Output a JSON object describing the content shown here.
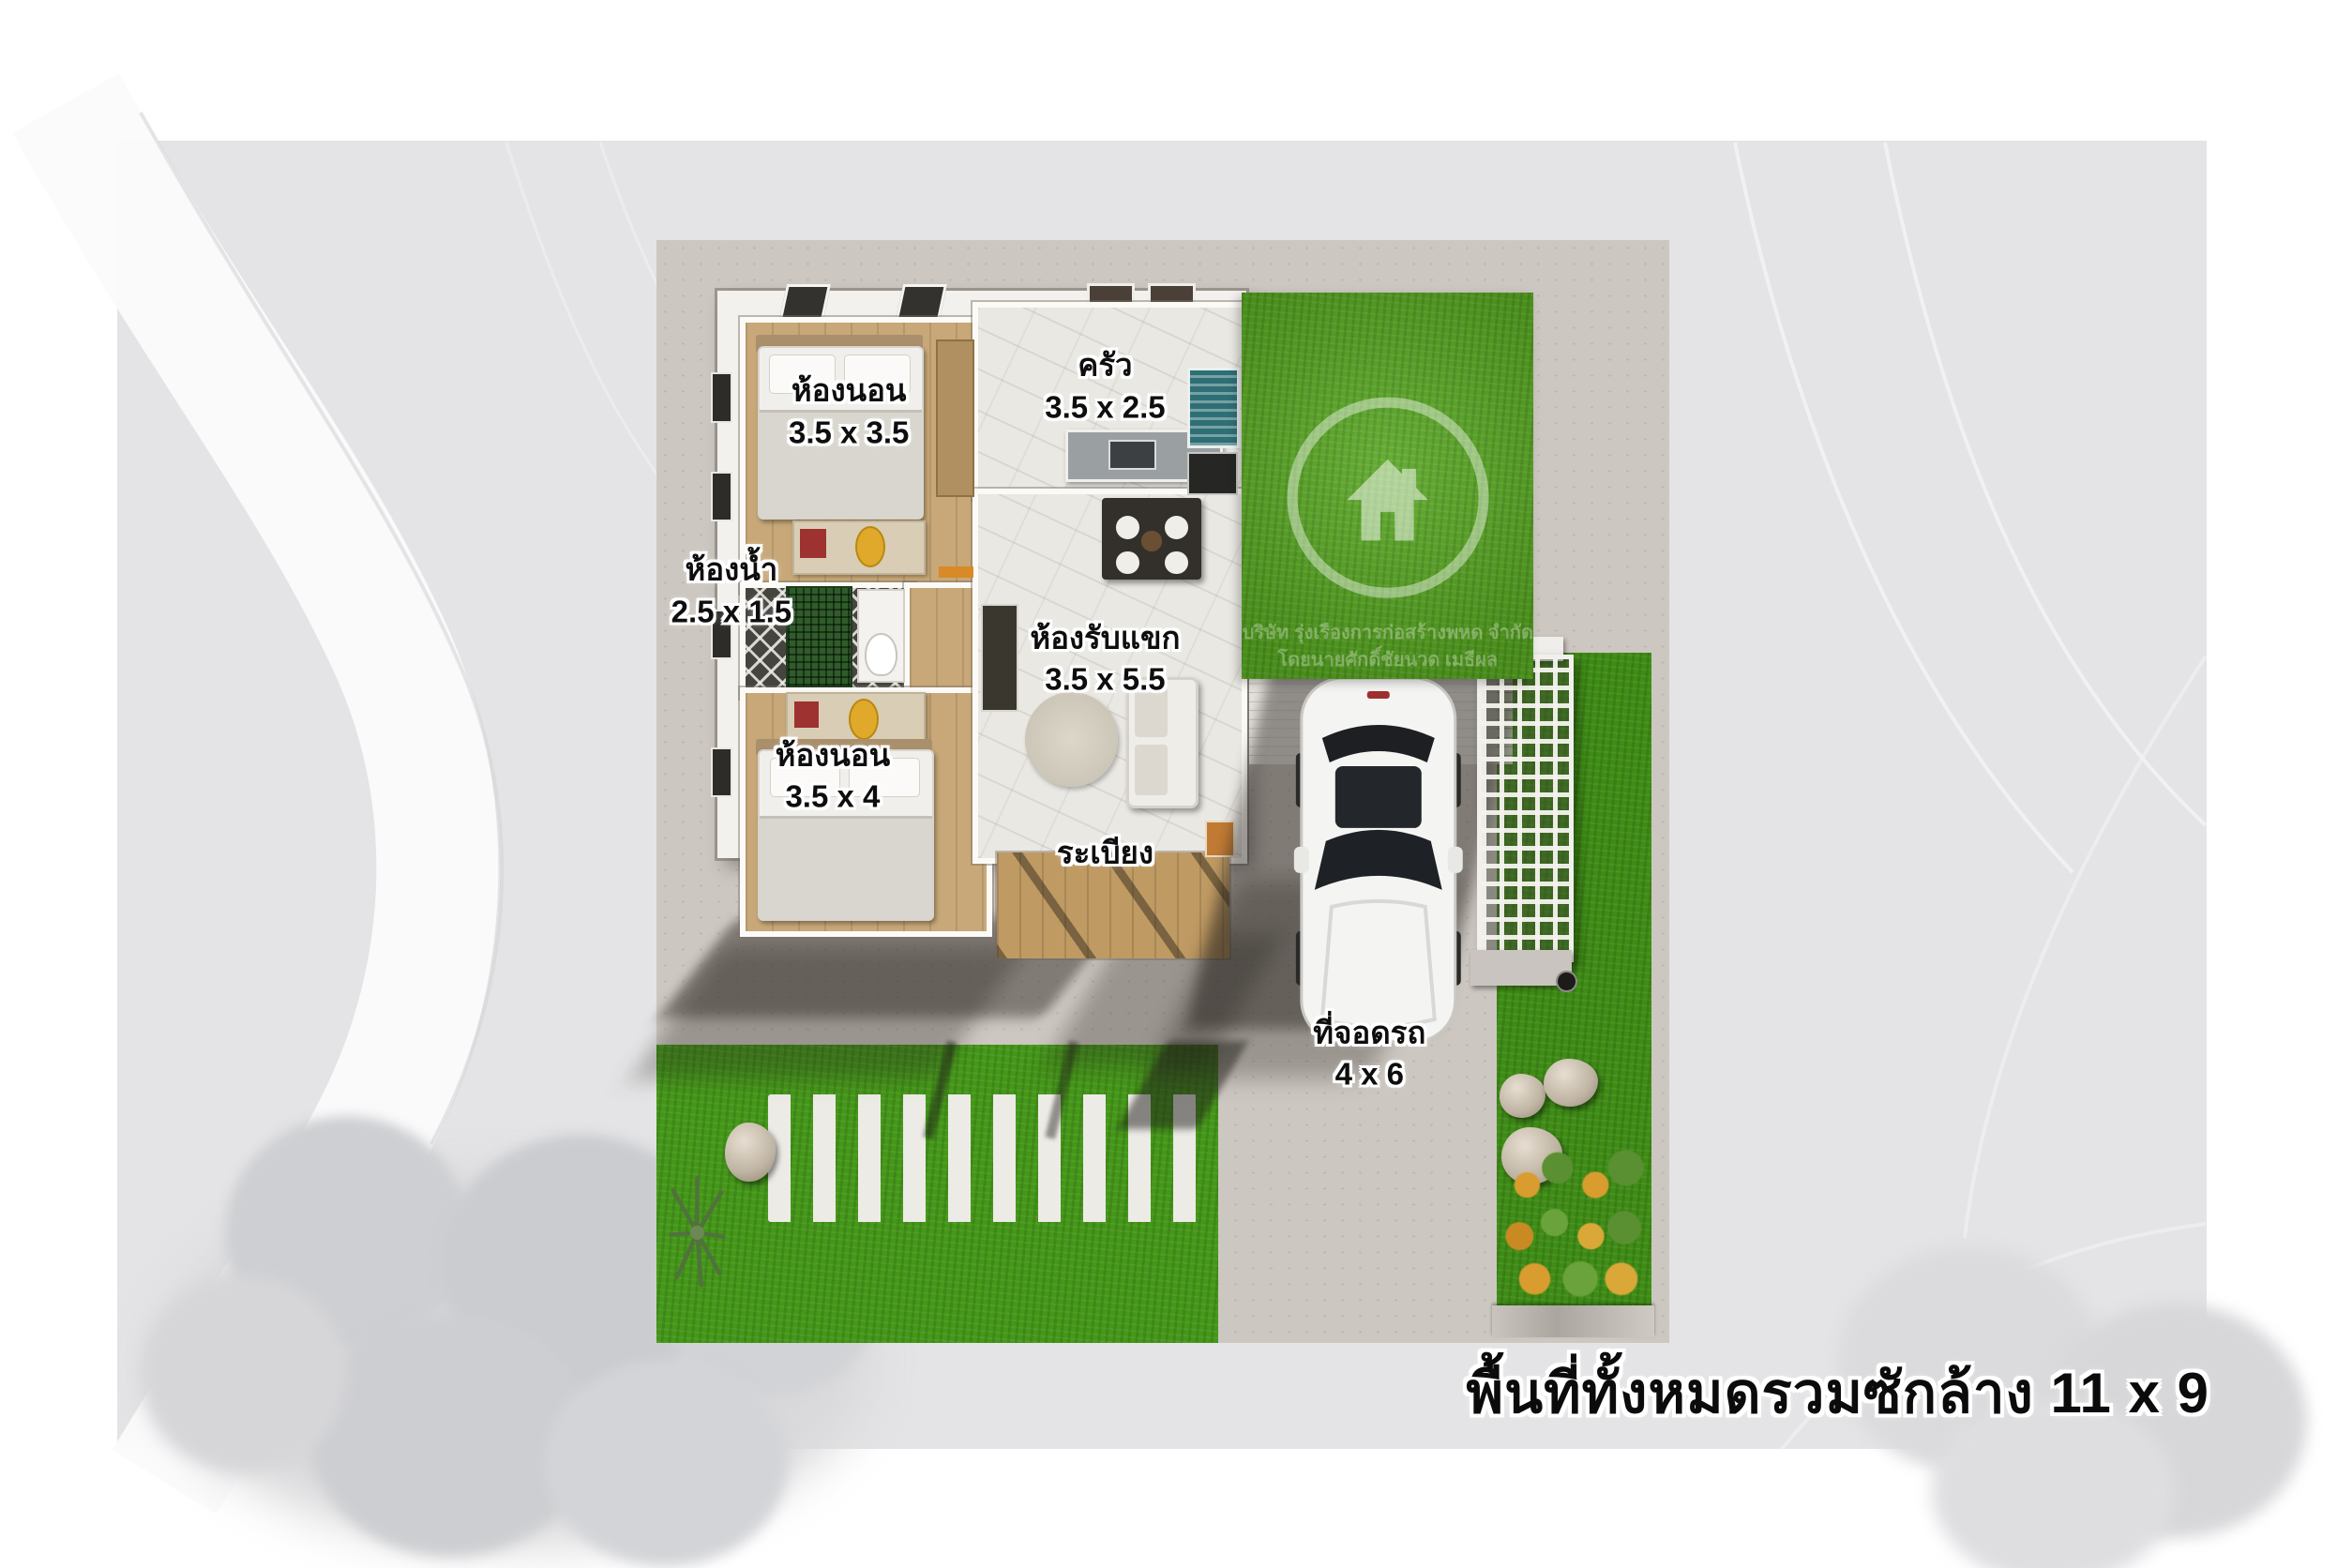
{
  "image_type": "floor-plan-render",
  "plan": {
    "rooms": [
      {
        "id": "bedroom-top",
        "name": "ห้องนอน",
        "dims": "3.5 x 3.5"
      },
      {
        "id": "kitchen",
        "name": "ครัว",
        "dims": "3.5 x 2.5"
      },
      {
        "id": "bathroom",
        "name": "ห้องน้ำ",
        "dims": "2.5 x 1.5"
      },
      {
        "id": "living-room",
        "name": "ห้องรับแขก",
        "dims": "3.5 x 5.5"
      },
      {
        "id": "bedroom-bottom",
        "name": "ห้องนอน",
        "dims": "3.5 x 4"
      },
      {
        "id": "porch",
        "name": "ระเบียง",
        "dims": ""
      },
      {
        "id": "carport",
        "name": "ที่จอดรถ",
        "dims": "4 x 6"
      }
    ],
    "total_area_label": "พื้นที่ทั้งหมดรวมซักล้าง 11 x 9",
    "watermark": {
      "logo": "house-in-circle",
      "line1": "บริษัท รุ่งเรืองการก่อสร้างพหด จำกัด",
      "line2": "โดยนายศักดิ์ชัยนวด เมธีผล"
    },
    "colors": {
      "logo_grass": "#55a51f",
      "yard_grass": "#449718",
      "concrete": "#cdc7c1",
      "wood_floor": "#c8a878",
      "porch_wood": "#bf9a62",
      "label_text": "#0e0e0e",
      "label_outline": "#ffffff",
      "car_body": "#f4f4f2",
      "accent_plant_orange": "#d99c2e"
    }
  }
}
